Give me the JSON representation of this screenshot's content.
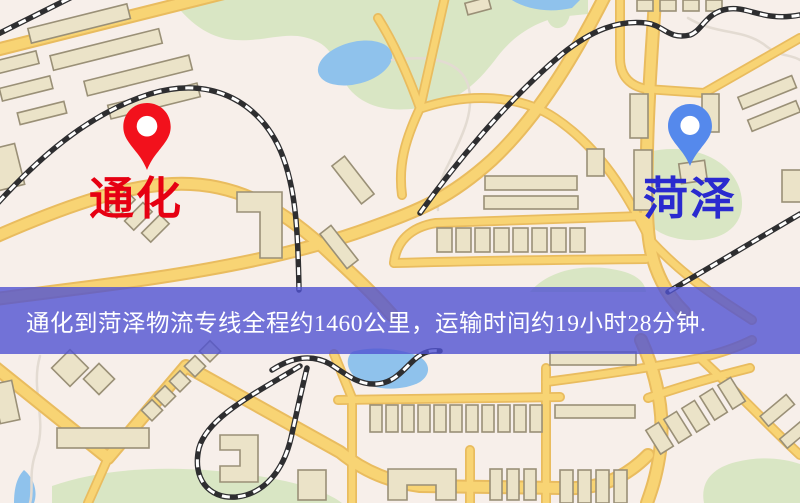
{
  "banner": {
    "text": "通化到菏泽物流专线全程约1460公里，运输时间约19小时28分钟."
  },
  "markers": {
    "origin": {
      "label": "通化",
      "pin_icon": "map-pin"
    },
    "destination": {
      "label": "菏泽",
      "pin_icon": "map-pin"
    }
  },
  "colors": {
    "background": "#F7EFEA",
    "road_fill": "#F8D474",
    "road_casing": "#E9BC5F",
    "park": "#D9E6C4",
    "water": "#8FC2EC",
    "building_fill": "#EBE3C8",
    "building_stroke": "#9A9077",
    "railway": "#2E2E30",
    "path_line": "#E3DBD2",
    "banner_bg": "rgba(80,82,210,0.8)",
    "banner_text": "#FFFFFF",
    "origin_pin": "#F2111C",
    "origin_label": "#E60012",
    "dest_pin": "#5589EC",
    "dest_label": "#2A2ACF"
  }
}
